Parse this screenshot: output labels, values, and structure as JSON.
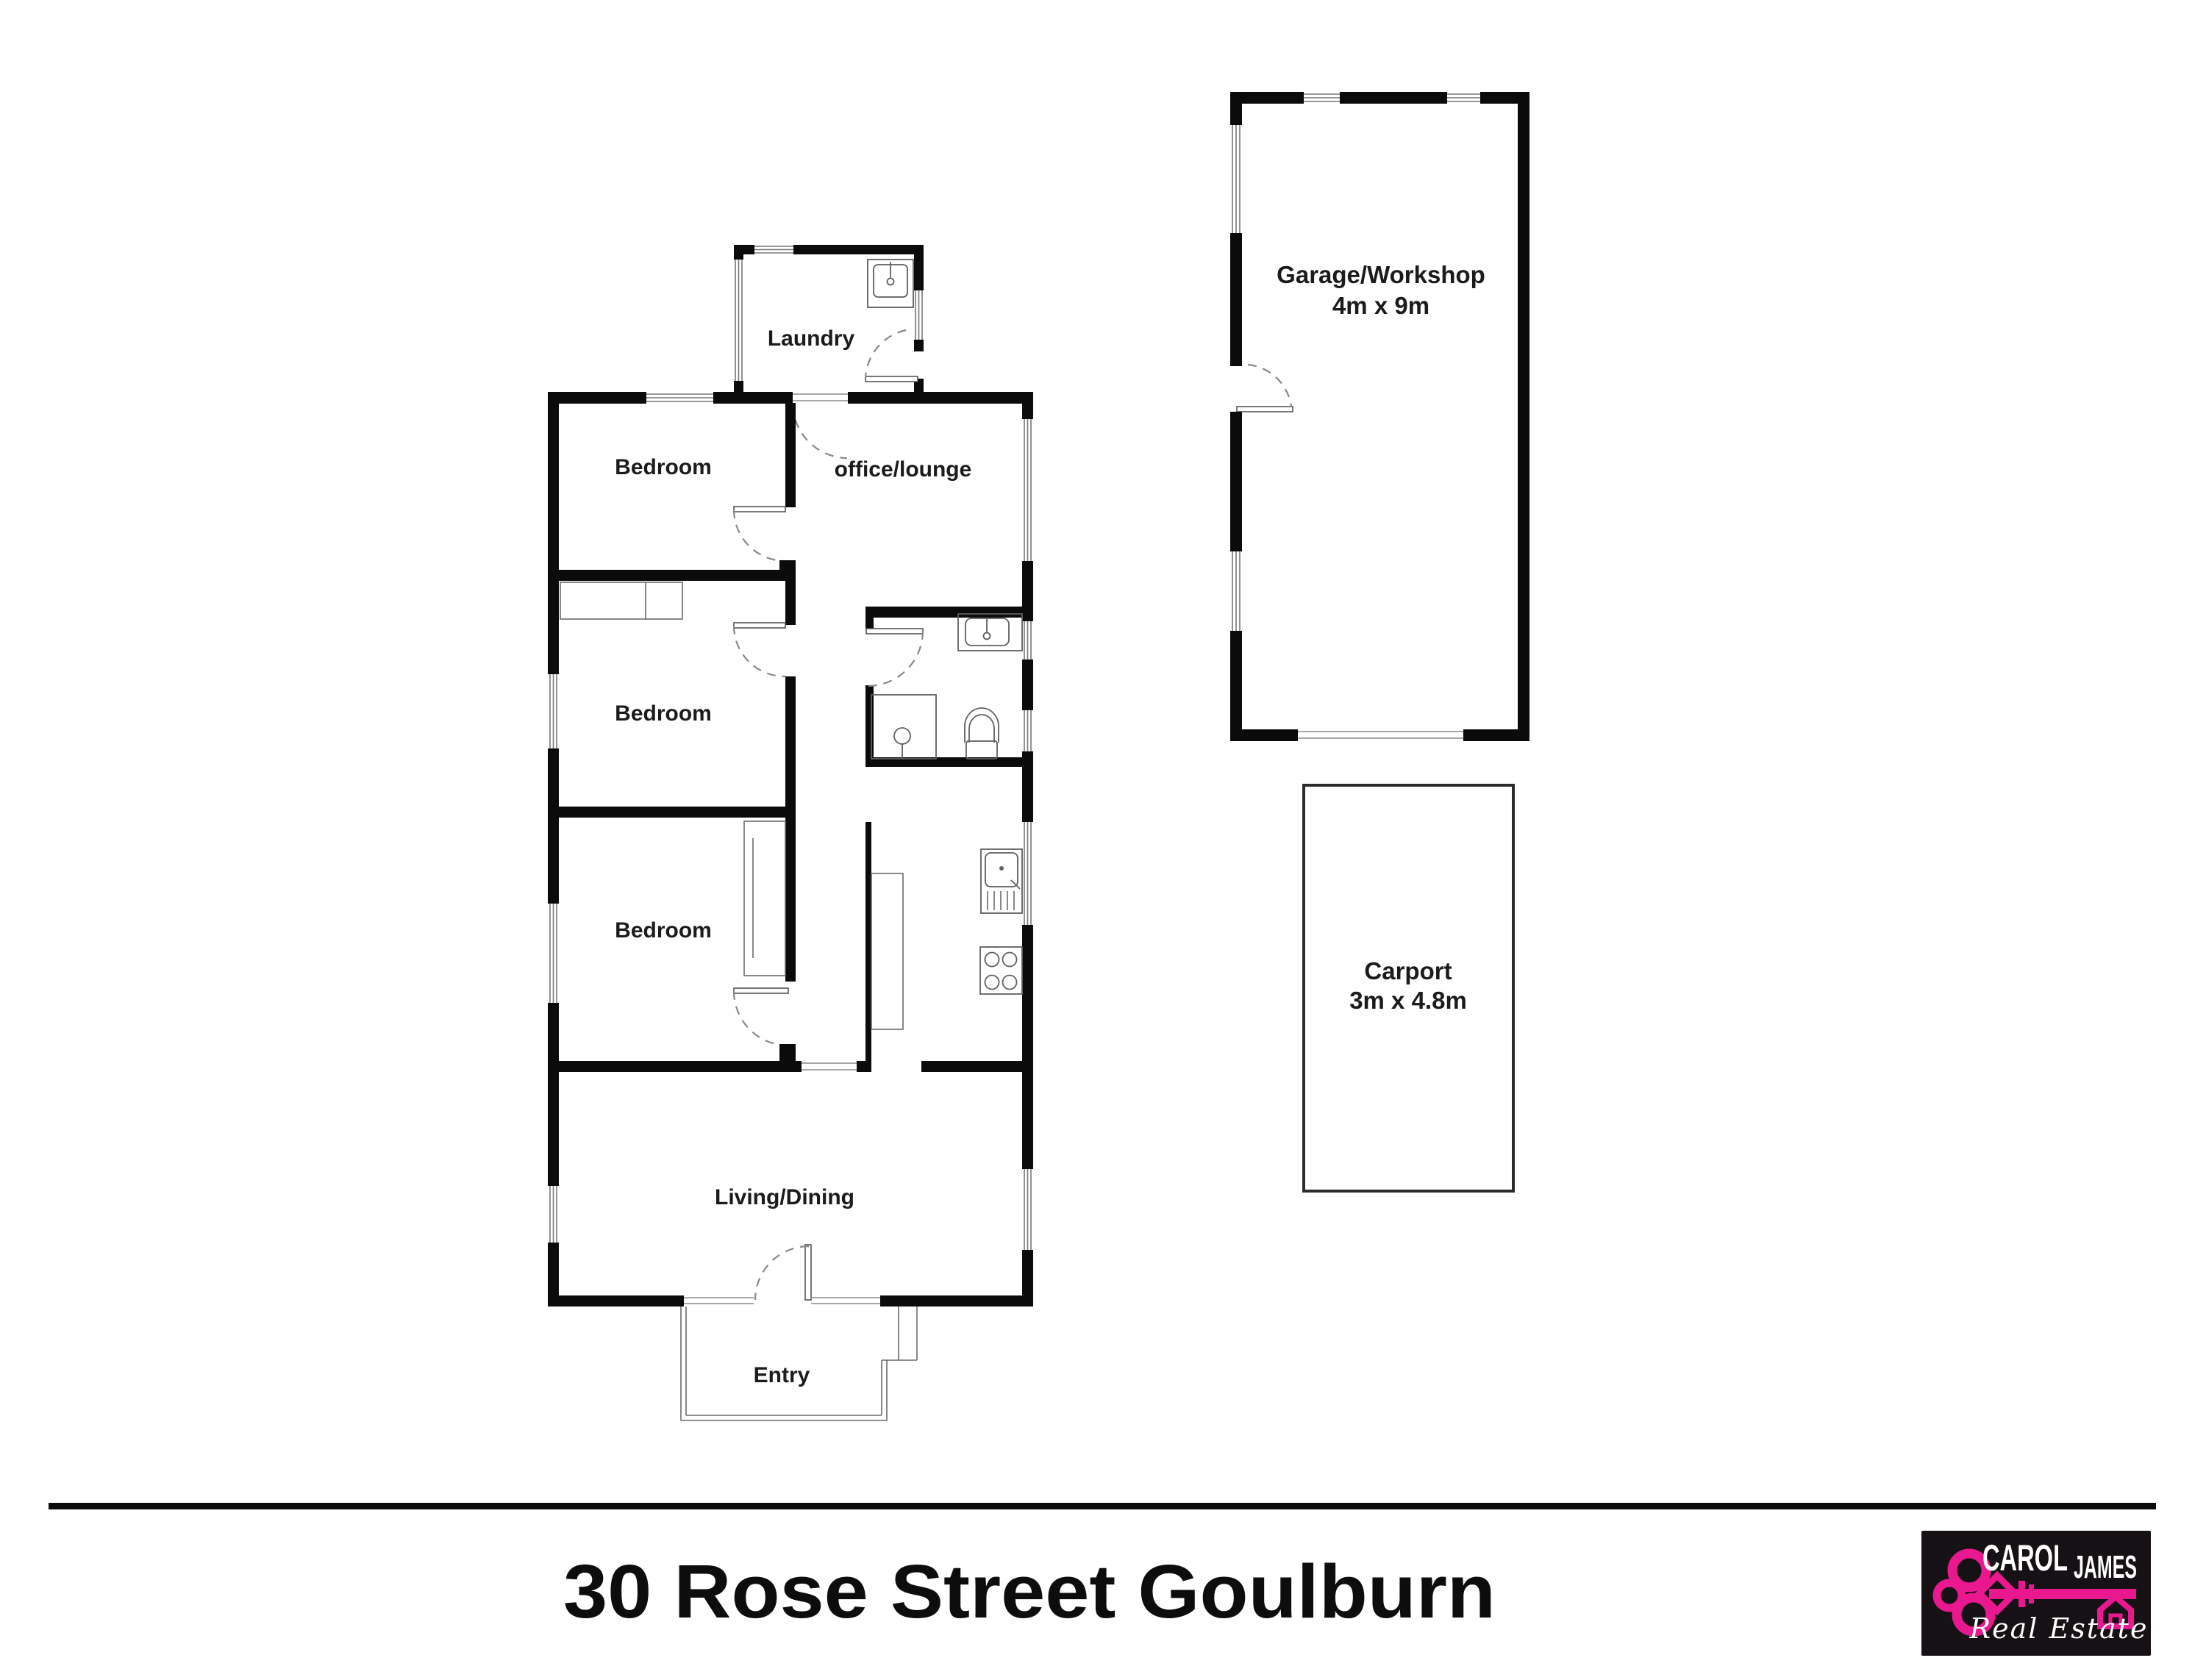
{
  "plan": {
    "rooms": {
      "laundry": "Laundry",
      "bedroom1": "Bedroom",
      "bedroom2": "Bedroom",
      "bedroom3": "Bedroom",
      "office": "office/lounge",
      "living": "Living/Dining",
      "entry": "Entry"
    },
    "outbuildings": {
      "garage": {
        "name": "Garage/Workshop",
        "dims": "4m x 9m"
      },
      "carport": {
        "name": "Carport",
        "dims": "3m x 4.8m"
      }
    }
  },
  "footer": {
    "address": "30 Rose Street Goulburn"
  },
  "logo": {
    "brand_first": "CAROL",
    "brand_second": "JAMES",
    "tagline": "Real Estate"
  },
  "colors": {
    "wall": "#0b0b0b",
    "accent_pink": "#e9188e",
    "logo_background": "#151114",
    "background": "#ffffff"
  }
}
